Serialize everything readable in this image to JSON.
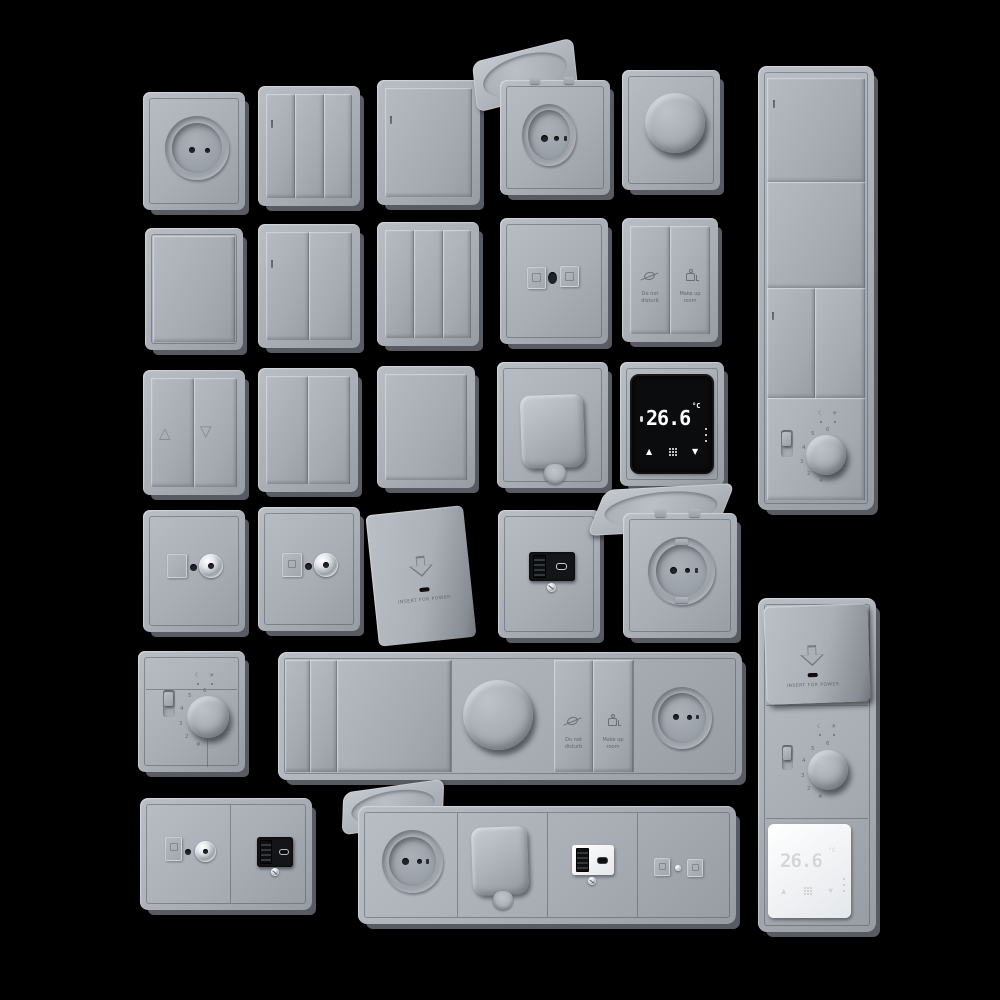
{
  "scene": {
    "description": "3D render set of gray wall switches, power sockets, data outlets, card holders and thermostats on a black background",
    "colors": {
      "background": "#000000",
      "plate_gray": "#a9aeb5",
      "screen_black": "#0b0c0e",
      "thermostat_white": "#f2f4f6",
      "chrome": "#dfe3e7",
      "display_digits": "#ffffff"
    }
  },
  "labels": {
    "dnd1": "Do not",
    "dnd2": "disturb",
    "mur1": "Make up",
    "mur2": "room",
    "insert_for_power": "INSERT FOR POWER"
  },
  "digital_thermostat": {
    "temperature": "26.6",
    "unit": "°C",
    "up_icon": "▲",
    "down_icon": "▼"
  },
  "analog_thermostat": {
    "scale": [
      "2",
      "3",
      "4",
      "5",
      "6"
    ],
    "frost_icon": "❄",
    "night_icon": "☾",
    "day_icon": "☀"
  },
  "blind_switch": {
    "up_icon": "△",
    "down_icon": "▽"
  }
}
